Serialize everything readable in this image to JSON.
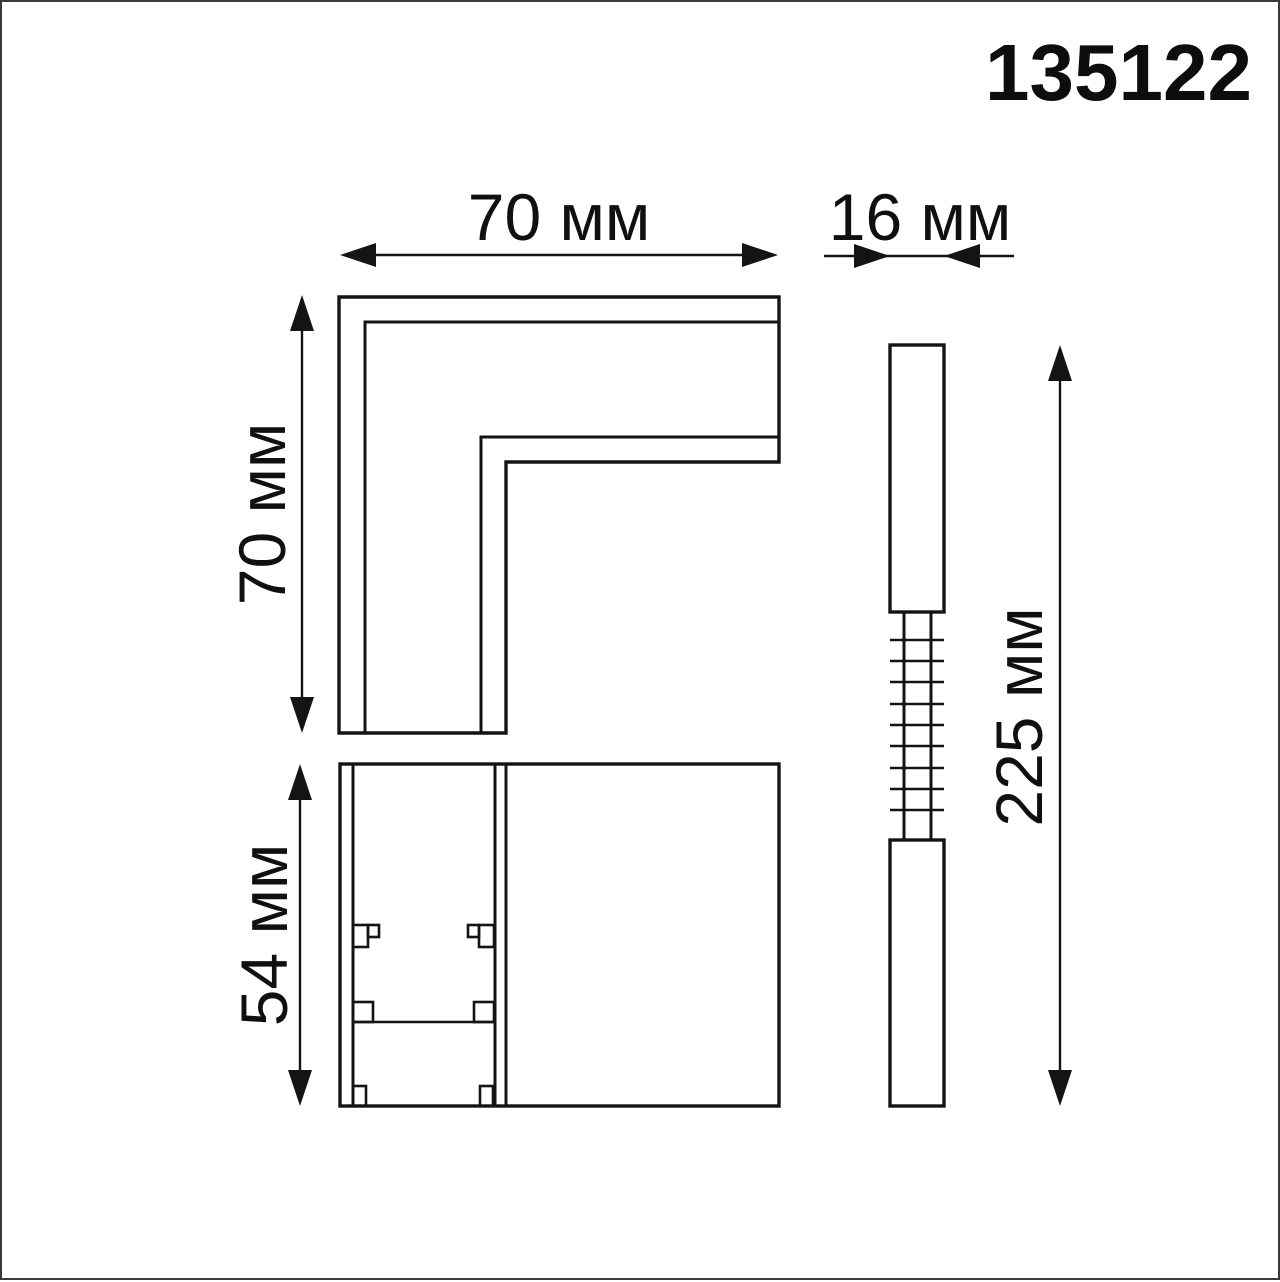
{
  "product_code": "135122",
  "labels": {
    "top_width": "70 мм",
    "connector_width": "16 мм",
    "left_height": "70 мм",
    "front_height": "54 мм",
    "total_length": "225 мм"
  },
  "colors": {
    "line": "#141414",
    "background": "#ffffff",
    "page_border": "#3a3a3a"
  }
}
